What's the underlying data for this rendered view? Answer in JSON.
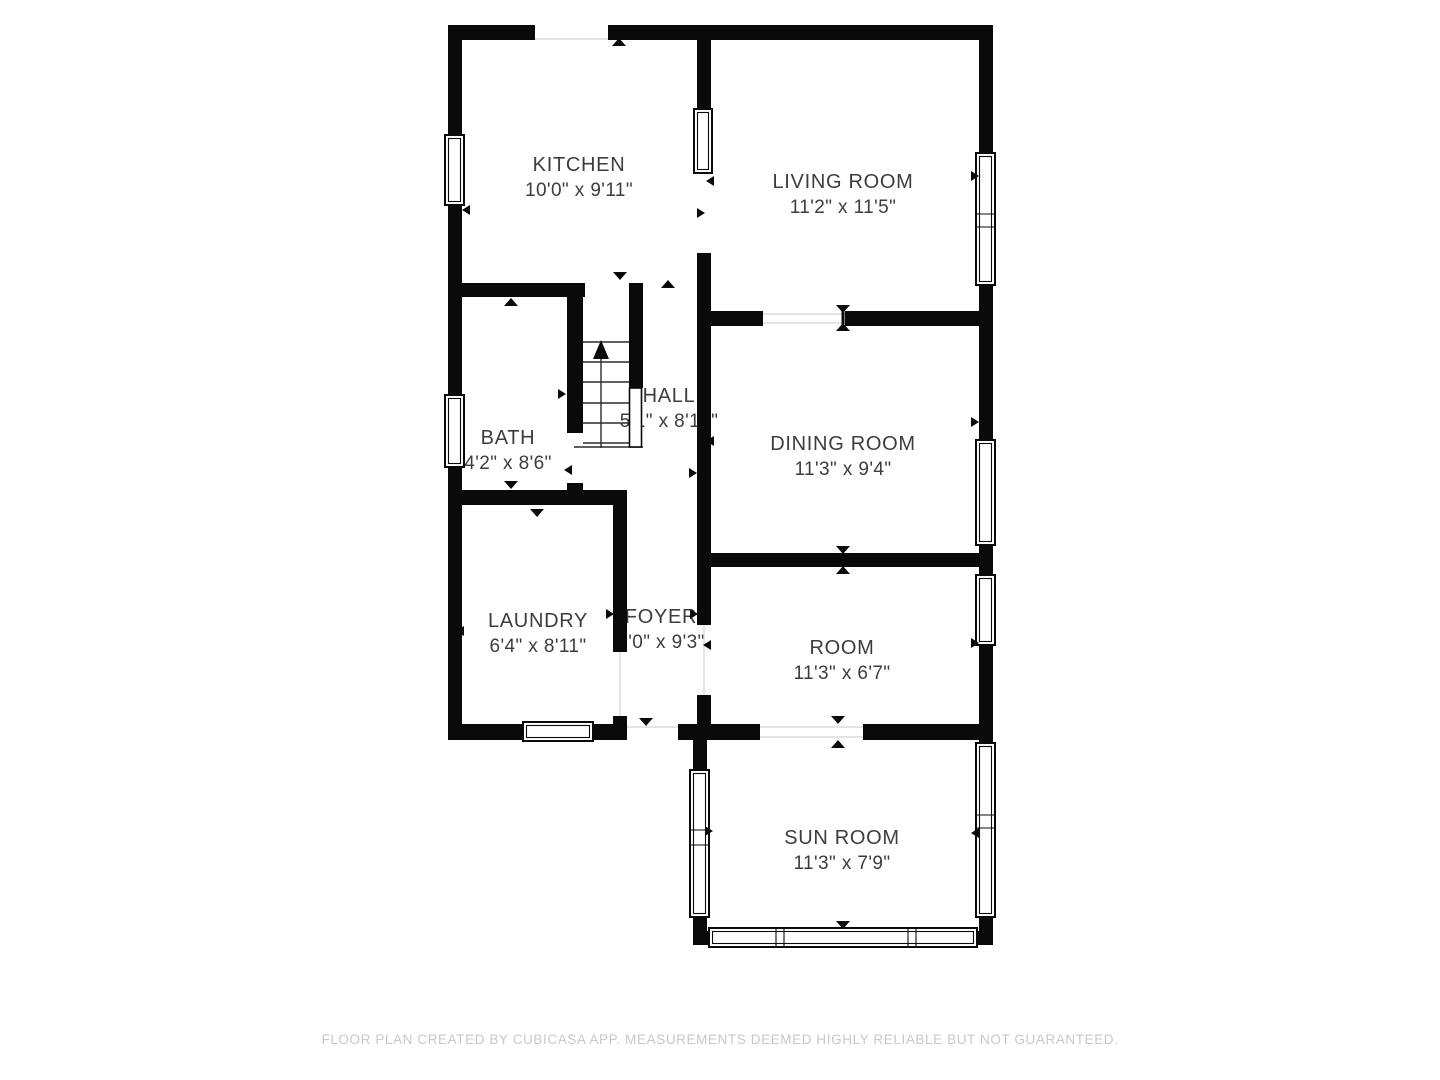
{
  "rooms": [
    {
      "id": "kitchen",
      "name": "KITCHEN",
      "dimensions": "10'0\" x 9'11\""
    },
    {
      "id": "living-room",
      "name": "LIVING ROOM",
      "dimensions": "11'2\" x 11'5\""
    },
    {
      "id": "bath",
      "name": "BATH",
      "dimensions": "4'2\" x 8'6\""
    },
    {
      "id": "hall",
      "name": "HALL",
      "dimensions": "5'1\" x 8'10\""
    },
    {
      "id": "dining-room",
      "name": "DINING ROOM",
      "dimensions": "11'3\" x 9'4\""
    },
    {
      "id": "laundry",
      "name": "LAUNDRY",
      "dimensions": "6'4\" x 8'11\""
    },
    {
      "id": "foyer",
      "name": "FOYER",
      "dimensions": "3'0\" x 9'3\""
    },
    {
      "id": "room",
      "name": "ROOM",
      "dimensions": "11'3\" x 6'7\""
    },
    {
      "id": "sun-room",
      "name": "SUN ROOM",
      "dimensions": "11'3\" x 7'9\""
    }
  ],
  "footer": {
    "disclaimer": "FLOOR PLAN CREATED BY CUBICASA APP. MEASUREMENTS DEEMED HIGHLY RELIABLE BUT NOT GUARANTEED."
  },
  "colors": {
    "wall": "#0a0a0a",
    "label_text": "#3d3d3d",
    "footer_text": "#c8c8c8",
    "background": "#ffffff"
  }
}
